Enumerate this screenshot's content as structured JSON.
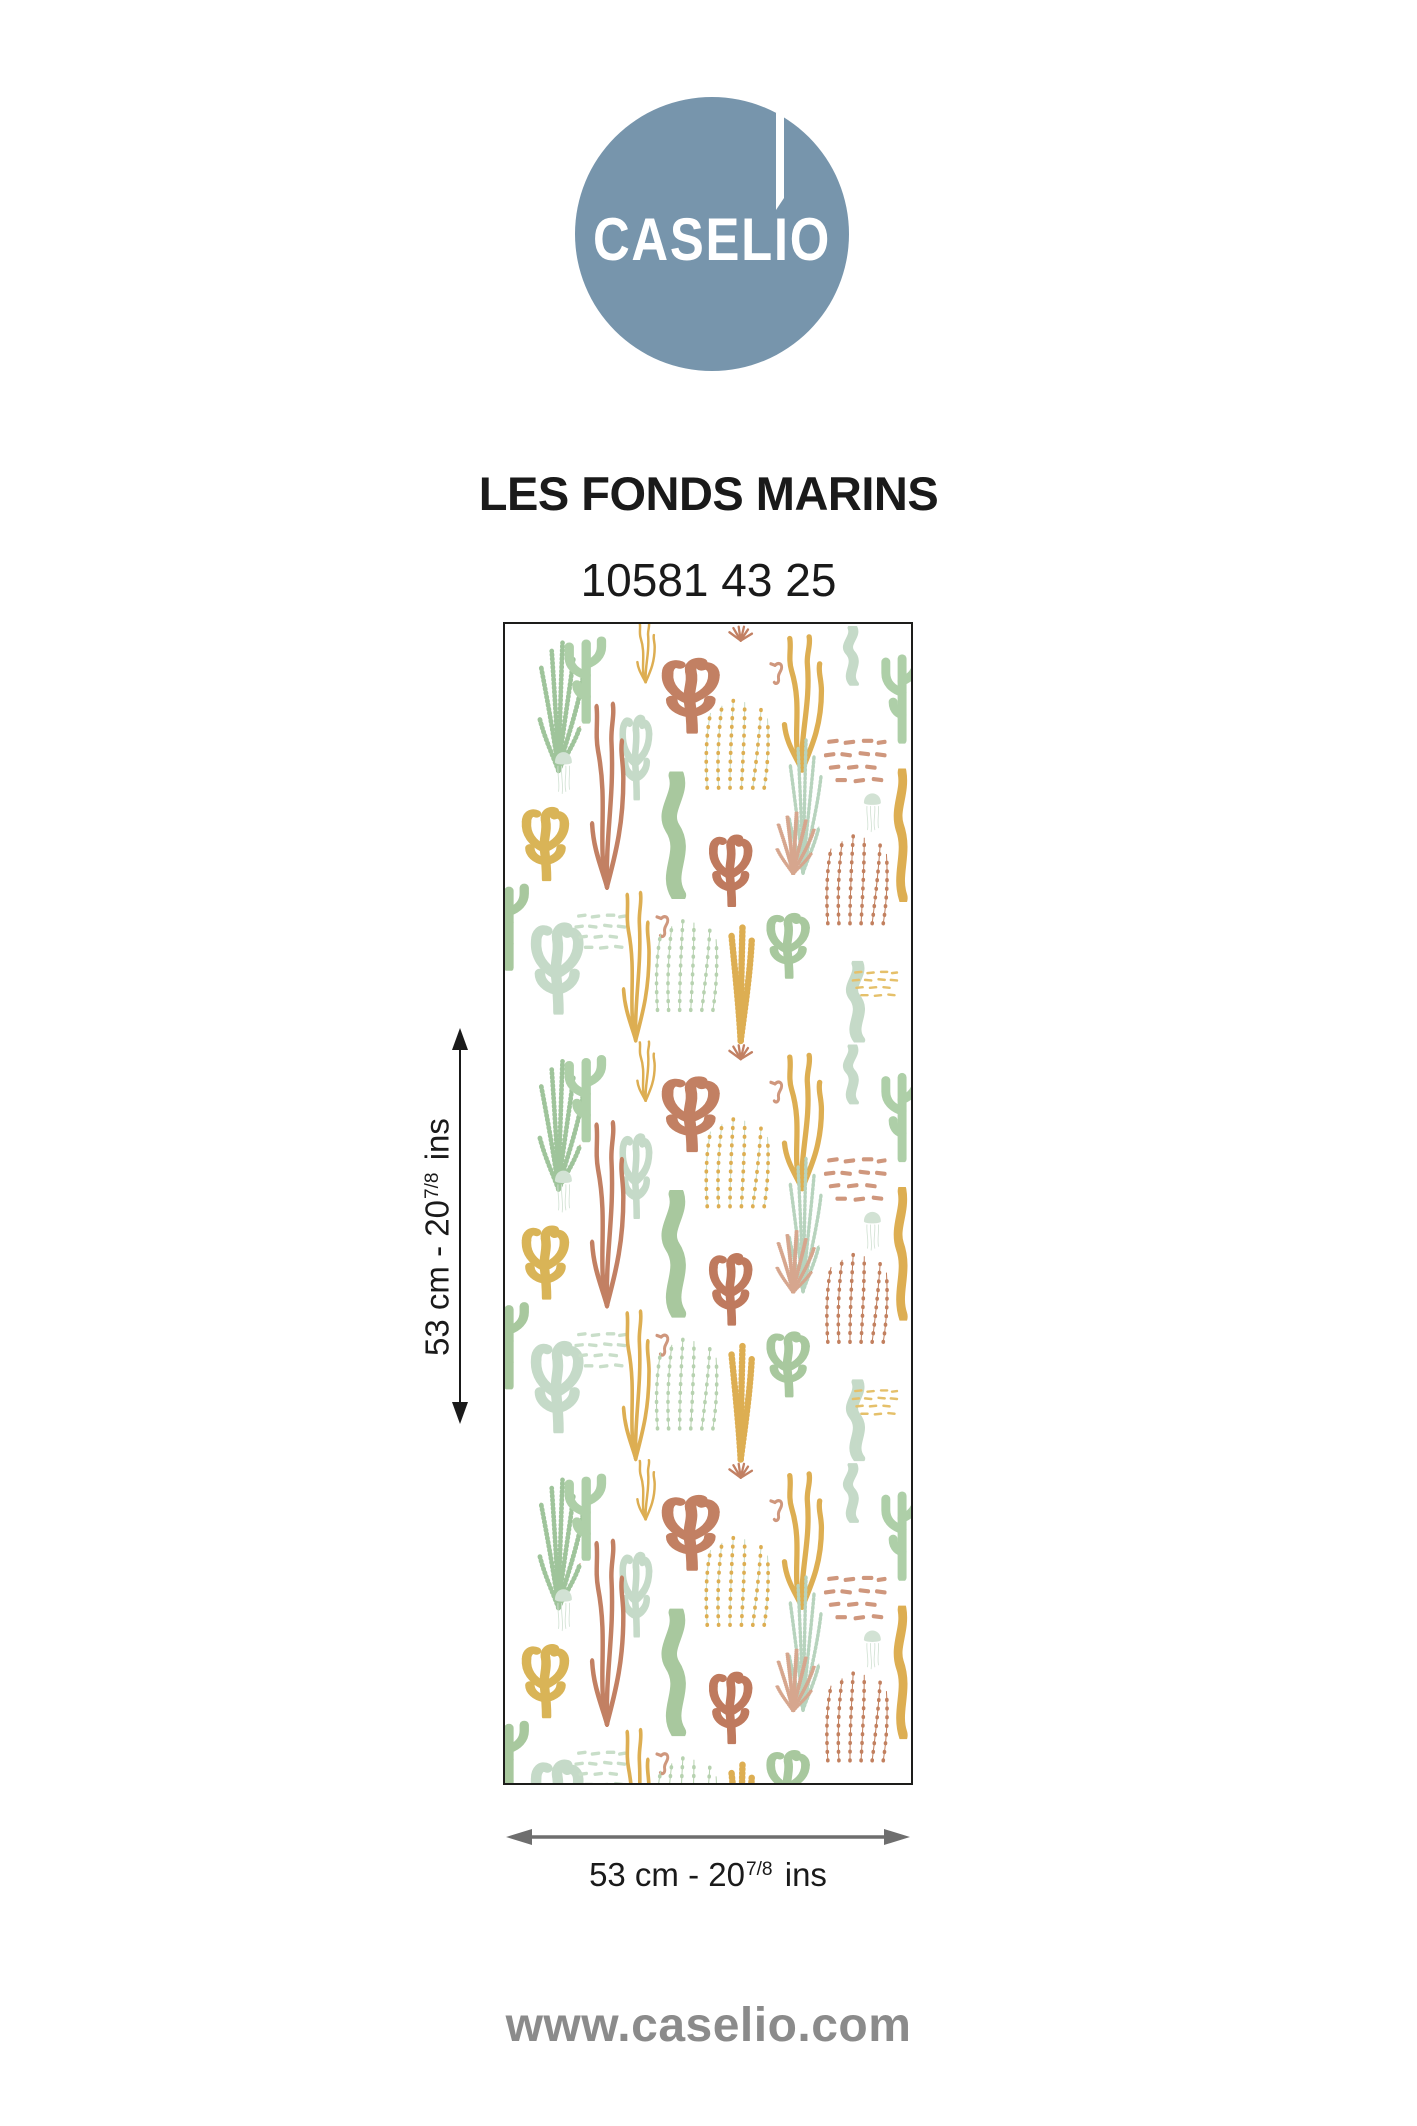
{
  "brand": {
    "logo_text": "CASELIO",
    "website": "www.caselio.com"
  },
  "product": {
    "collection_name": "LES FONDS MARINS",
    "reference": "10581 43 25"
  },
  "dimensions": {
    "height": {
      "prefix": "53 cm - 20",
      "fraction": "7/8",
      "suffix": " ins"
    },
    "width": {
      "prefix": "53 cm - 20",
      "fraction": "7/8",
      "suffix": " ins"
    }
  },
  "swatch": {
    "description": "Les Fonds Marins seaweed, coral, jellyfish and seahorse wallpaper motif on white"
  },
  "palette": {
    "logoBlue": "#7795ac",
    "logoText": "#ffffff",
    "ink": "#1a1a1a",
    "arrowBlack": "#1a1a1a",
    "arrowGray": "#6e6e6e",
    "websiteGray": "#8b8b8b",
    "swatchBorder": "#1d1d1b",
    "sage": "#9fc49b",
    "sage2": "#a8c89e",
    "cactus": "#aecfa8",
    "mint": "#c5dac8",
    "mintLeaf": "#b7d3bd",
    "paleGreen": "#c9dec9",
    "sageDots": "#b7d2b0",
    "jelly": "#d2e2d4",
    "gold": "#ddae52",
    "gold2": "#d9b457",
    "goldLight": "#e5c06a",
    "terra": "#c28063",
    "terra2": "#bf7a5e",
    "terra3": "#c2805f",
    "salmon": "#cf977d",
    "salmonLeaf": "#d6a68e"
  }
}
